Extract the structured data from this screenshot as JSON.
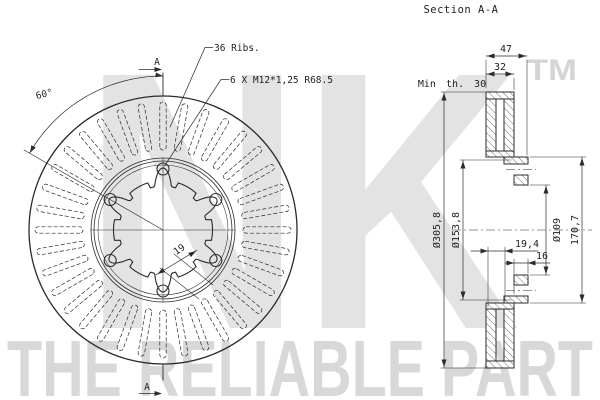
{
  "drawing": {
    "section_title": "Section A-A",
    "watermark": {
      "brand": "NK",
      "tm": "TM",
      "slogan": "THE RELIABLE PART"
    },
    "front_view": {
      "ribs_count": 36,
      "bolt_count": 6,
      "ribs_label": "36 Ribs.",
      "bolts_label": "6 X M12*1,25 R68.5",
      "angle_label": "60°",
      "rib_width_label": "19",
      "cut_label": "A"
    },
    "section_view": {
      "overall_width": "47",
      "thickness": "32",
      "min_thickness": "Min th. 30",
      "outer_diameter": "Ø305,8",
      "hat_step_diameter": "Ø153,8",
      "center_bore": "Ø109",
      "hat_outer_diameter": "170,7",
      "pad_depth": "19,4",
      "flange_thickness": "16"
    },
    "colors": {
      "line": "#2b2b2b",
      "hatch": "#4a4a4a",
      "watermark_block": "#e3e3e3",
      "watermark_text": "#d8d8d8",
      "background": "#ffffff"
    }
  }
}
